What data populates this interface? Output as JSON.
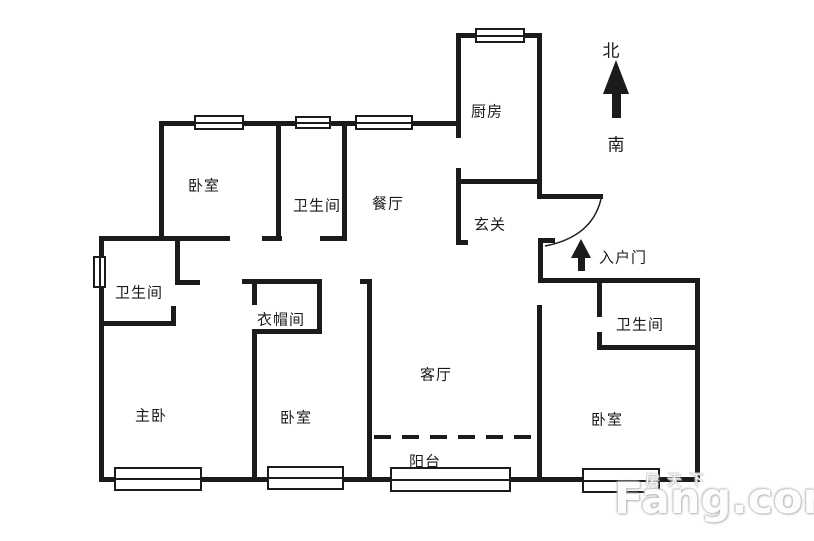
{
  "compass": {
    "north": "北",
    "south": "南"
  },
  "rooms": {
    "kitchen": "厨房",
    "bedroom_top": "卧室",
    "bathroom_top": "卫生间",
    "dining": "餐厅",
    "foyer": "玄关",
    "bathroom_left": "卫生间",
    "cloakroom": "衣帽间",
    "living_room": "客厅",
    "master_bedroom": "主卧",
    "bedroom_middle": "卧室",
    "bedroom_right": "卧室",
    "bathroom_right": "卫生间",
    "balcony": "阳台"
  },
  "entry": {
    "label": "入户门"
  },
  "watermark": {
    "site_cn": "房天下",
    "site_en": "Fang.com"
  },
  "colors": {
    "wall": "#1b1b1b",
    "background": "#ffffff"
  }
}
